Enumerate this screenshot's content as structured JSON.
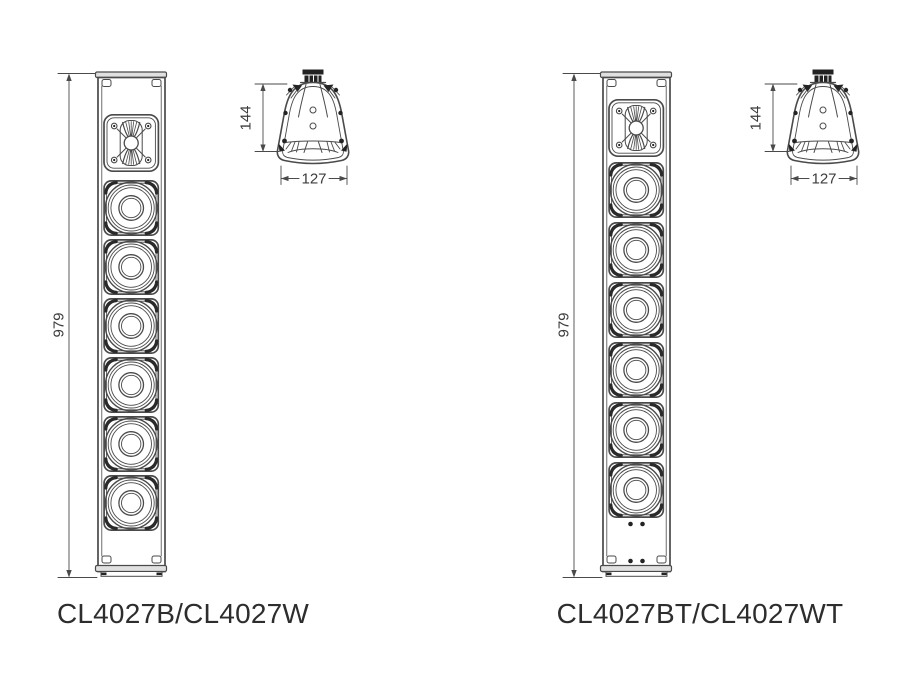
{
  "figures": [
    {
      "model_label": "CL4027B/CL4027W",
      "front_view": {
        "height_dim_label": "979",
        "tweeter_count": 1,
        "woofer_count": 6
      },
      "top_view": {
        "depth_dim_label": "144",
        "width_dim_label": "127"
      }
    },
    {
      "model_label": "CL4027BT/CL4027WT",
      "front_view": {
        "height_dim_label": "979",
        "tweeter_count": 1,
        "woofer_count": 6
      },
      "top_view": {
        "depth_dim_label": "144",
        "width_dim_label": "127"
      }
    }
  ],
  "colors": {
    "line": "#4a4a4a",
    "dark_fill": "#232323",
    "label_text": "#2d2d2d",
    "background": "#ffffff"
  }
}
